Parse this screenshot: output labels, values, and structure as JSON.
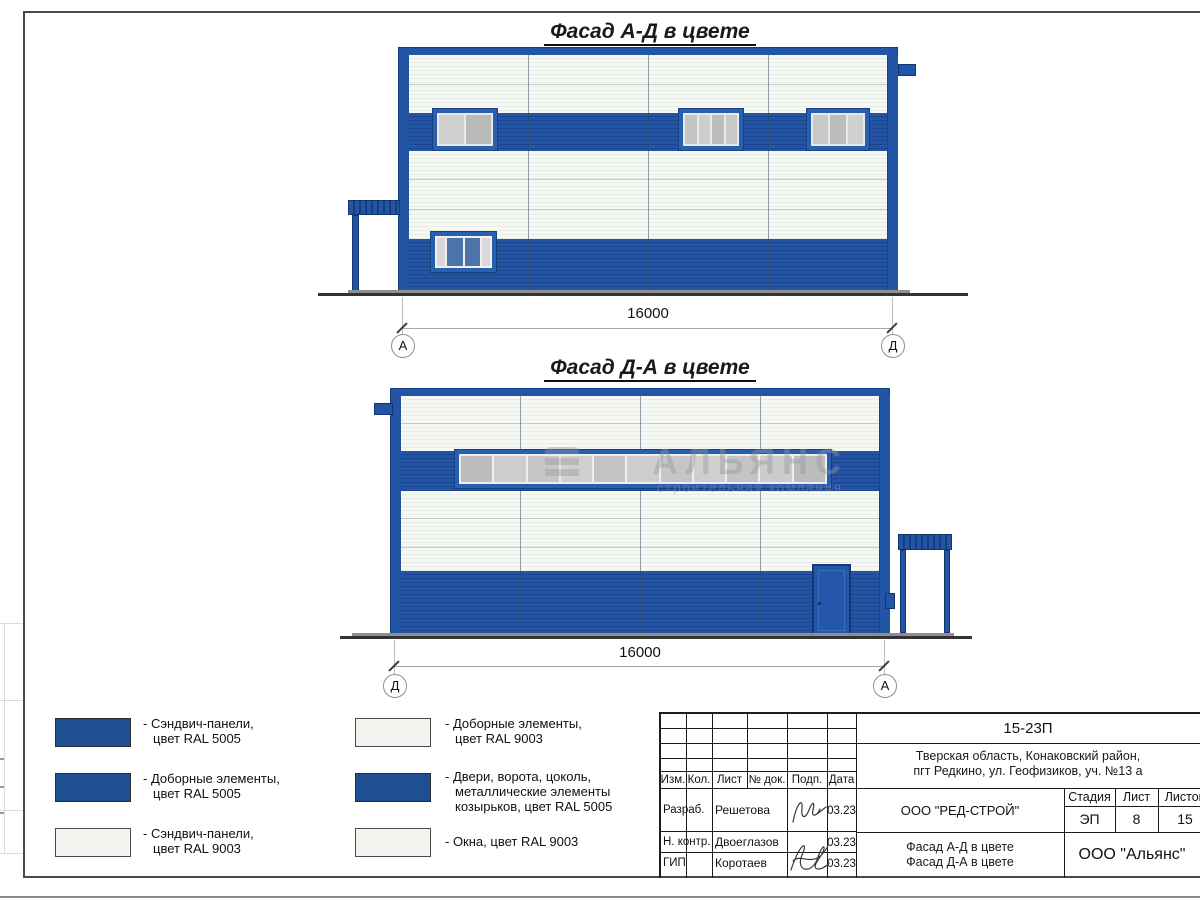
{
  "colors": {
    "ral5005_blue": "#1d4f91",
    "ral9003_white": "#f3f4f0",
    "facade_panel_blue": "#2355a7",
    "facade_panel_white": "#f6f8f4"
  },
  "facade_ad": {
    "title": "Фасад А-Д в цвете",
    "dimension": "16000",
    "axis_left": "А",
    "axis_right": "Д"
  },
  "facade_da": {
    "title": "Фасад Д-А в цвете",
    "dimension": "16000",
    "axis_left": "Д",
    "axis_right": "А"
  },
  "watermark": {
    "name": "АЛЬЯНС",
    "tagline": "строительная компания"
  },
  "legend": {
    "items": [
      {
        "color": "#1d4f91",
        "lines": [
          "- Сэндвич-панели,",
          "цвет RAL 5005",
          ""
        ]
      },
      {
        "color": "#1d4f91",
        "lines": [
          "- Доборные элементы,",
          "цвет RAL 5005",
          ""
        ]
      },
      {
        "color": "#f3f4f0",
        "lines": [
          "- Сэндвич-панели,",
          "цвет RAL 9003",
          ""
        ]
      },
      {
        "color": "#f3f4f0",
        "lines": [
          "- Доборные элементы,",
          "цвет RAL 9003",
          ""
        ]
      },
      {
        "color": "#1d4f91",
        "lines": [
          "- Двери, ворота, цоколь,",
          "металлические элементы",
          "козырьков, цвет RAL 5005"
        ]
      },
      {
        "color": "#f3f4f0",
        "lines": [
          "- Окна, цвет RAL 9003",
          "",
          ""
        ]
      }
    ]
  },
  "titleblock": {
    "code": "15-23П",
    "address_line1": "Тверская область, Конаковский район,",
    "address_line2": "пгт Редкино, ул. Геофизиков, уч. №13 а",
    "cols": {
      "izm": "Изм.",
      "kol": "Кол.",
      "list": "Лист",
      "doc": "№ док.",
      "sign": "Подп.",
      "date": "Дата"
    },
    "rows": [
      {
        "role": "Разраб.",
        "name": "Решетова",
        "date": "03.23"
      },
      {
        "role": "Н. контр.",
        "name": "Двоеглазов",
        "date": "03.23"
      },
      {
        "role": "ГИП",
        "name": "Коротаев",
        "date": "03.23"
      }
    ],
    "designer": "ООО \"РЕД-СТРОЙ\"",
    "sheet_title_line1": "Фасад А-Д в цвете",
    "sheet_title_line2": "Фасад Д-А в цвете",
    "stage_label": "Стадия",
    "sheet_label": "Лист",
    "sheets_label": "Листов",
    "stage": "ЭП",
    "sheet_no": "8",
    "sheets_total": "15",
    "contractor": "ООО \"Альянс\""
  }
}
